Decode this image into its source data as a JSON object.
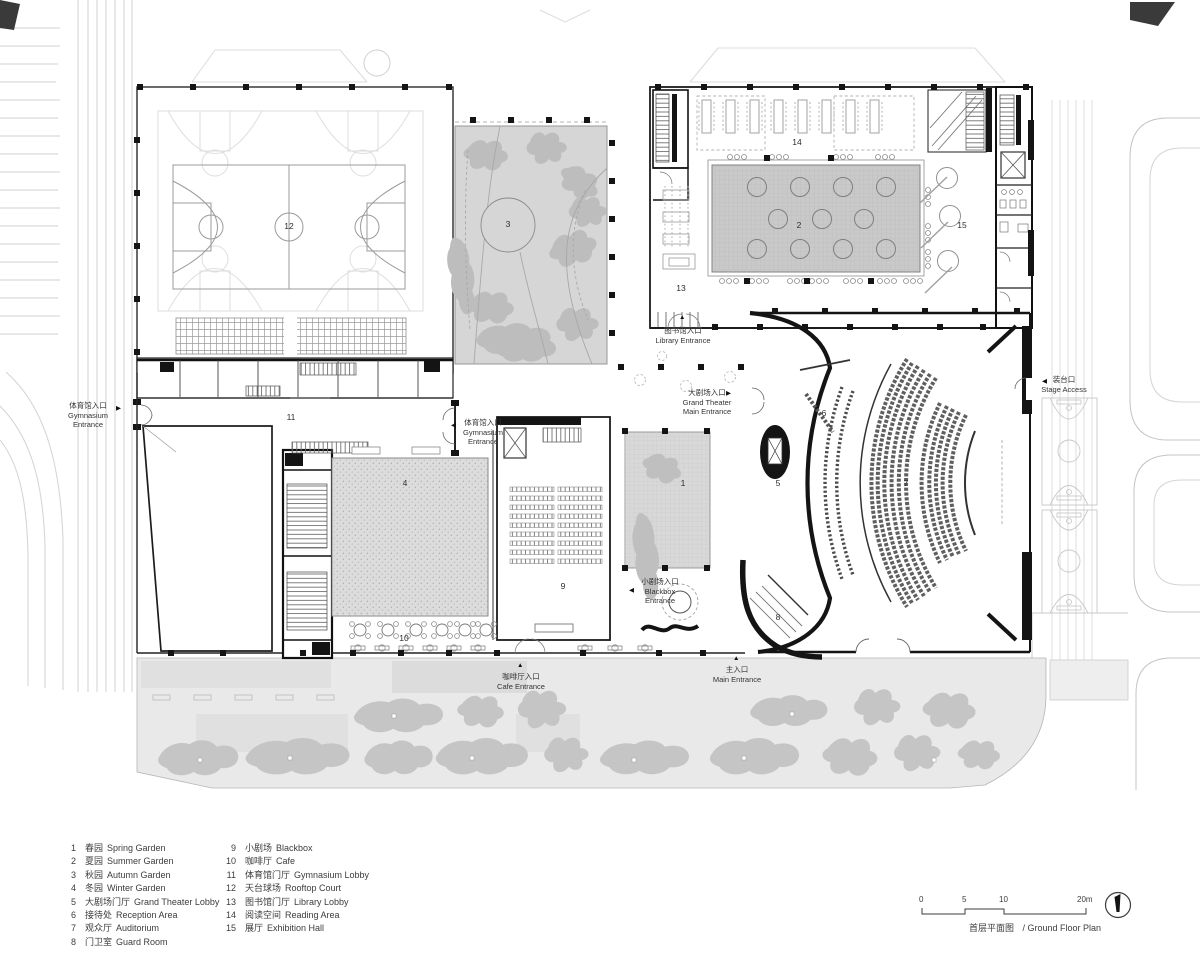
{
  "title": {
    "zh": "首层平面图",
    "en": "/ Ground Floor Plan"
  },
  "scale_bar": {
    "ticks": [
      "0",
      "5",
      "10",
      "20m"
    ]
  },
  "legend": {
    "left": [
      {
        "num": "1",
        "zh": "春园",
        "en": "Spring Garden"
      },
      {
        "num": "2",
        "zh": "夏园",
        "en": "Summer Garden"
      },
      {
        "num": "3",
        "zh": "秋园",
        "en": "Autumn Garden"
      },
      {
        "num": "4",
        "zh": "冬园",
        "en": "Winter Garden"
      },
      {
        "num": "5",
        "zh": "大剧场门厅",
        "en": "Grand Theater Lobby"
      },
      {
        "num": "6",
        "zh": "接待处",
        "en": "Reception Area"
      },
      {
        "num": "7",
        "zh": "观众厅",
        "en": "Auditorium"
      },
      {
        "num": "8",
        "zh": "门卫室",
        "en": "Guard Room"
      }
    ],
    "right": [
      {
        "num": "9",
        "zh": "小剧场",
        "en": "Blackbox"
      },
      {
        "num": "10",
        "zh": "咖啡厅",
        "en": "Cafe"
      },
      {
        "num": "11",
        "zh": "体育馆门厅",
        "en": "Gymnasium Lobby"
      },
      {
        "num": "12",
        "zh": "天台球场",
        "en": "Rooftop Court"
      },
      {
        "num": "13",
        "zh": "图书馆门厅",
        "en": "Library Lobby"
      },
      {
        "num": "14",
        "zh": "阅读空间",
        "en": "Reading Area"
      },
      {
        "num": "15",
        "zh": "展厅",
        "en": "Exhibition Hall"
      }
    ]
  },
  "plan": {
    "room_labels": {
      "r1": "1",
      "r2": "2",
      "r3": "3",
      "r4": "4",
      "r5": "5",
      "r6": "6",
      "r7": "7",
      "r8": "8",
      "r9": "9",
      "r10": "10",
      "r11": "11",
      "r12": "12",
      "r13": "13",
      "r14": "14",
      "r15": "15"
    }
  },
  "entrances": {
    "gym_left": {
      "zh": "体育馆入口",
      "en1": "Gymnasium",
      "en2": "Entrance",
      "arrow": "▶"
    },
    "gym_mid": {
      "zh": "体育馆入口",
      "en1": "Gymnasium",
      "en2": "Entrance",
      "arrow": "◀"
    },
    "library": {
      "zh": "图书馆入口",
      "en": "Library Entrance",
      "arrow": "▲"
    },
    "grand": {
      "zh": "大剧场入口",
      "en1": "Grand Theater",
      "en2": "Main Entrance",
      "arrow": "▶"
    },
    "stage": {
      "zh": "装台口",
      "en": "Stage Access",
      "arrow": "◀"
    },
    "blackbox": {
      "zh": "小剧场入口",
      "en1": "Blackbox",
      "en2": "Entrance",
      "arrow": "◀"
    },
    "cafe": {
      "zh": "咖啡厅入口",
      "en": "Cafe Entrance",
      "arrow": "▲"
    },
    "main": {
      "zh": "主入口",
      "en": "Main Entrance",
      "arrow": "▲"
    }
  },
  "colors": {
    "wall": "#141414",
    "garden_gray": "#cccccc",
    "plaza": "#e9e9e9",
    "tree": "#c4c4c4",
    "text": "#3c3c3c"
  }
}
